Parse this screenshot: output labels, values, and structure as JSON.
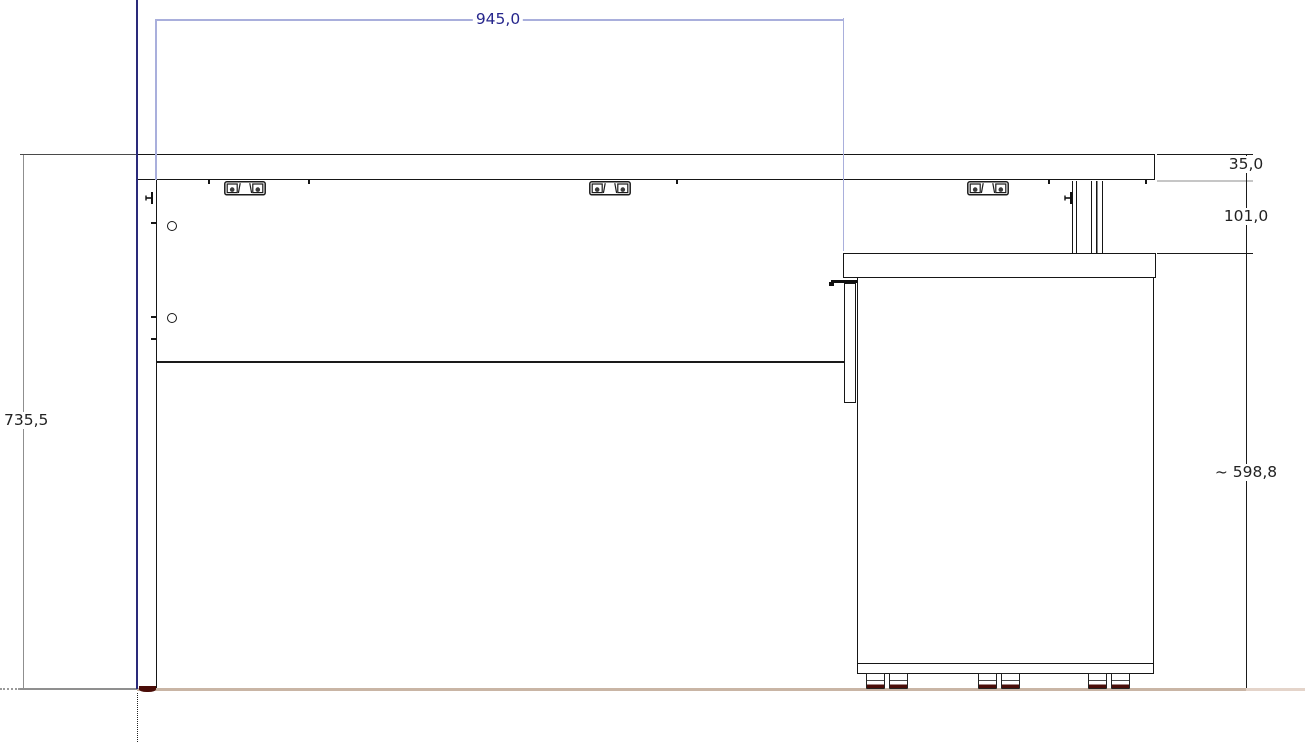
{
  "drawing": {
    "kind": "furniture-cad-elevation",
    "description": "Side elevation of a desk with worktop, left leg panel and pedestal cabinet, with dimension annotations",
    "dimensions": {
      "top_width": {
        "label": "945,0",
        "value_mm": 945.0
      },
      "total_height": {
        "label": "735,5",
        "value_mm": 735.5
      },
      "top_thickness": {
        "label": "35,0",
        "value_mm": 35.0
      },
      "clearance": {
        "label": "101,0",
        "value_mm": 101.0
      },
      "cabinet_height": {
        "label": "~ 598,8",
        "value_mm": 598.8,
        "approximate": true
      }
    },
    "colors": {
      "dimension_line_blue": "#a9afdc",
      "dimension_text_blue": "#26268c",
      "reference_line_navy": "#2a2a7a",
      "dimension_line_gray": "#8f8f8f",
      "extension_line_silver": "#c6c6c6",
      "outline_black": "#1a1a1a",
      "floor_tan": "#c9b5a5",
      "glide_dark_red": "#4a0d08"
    }
  }
}
